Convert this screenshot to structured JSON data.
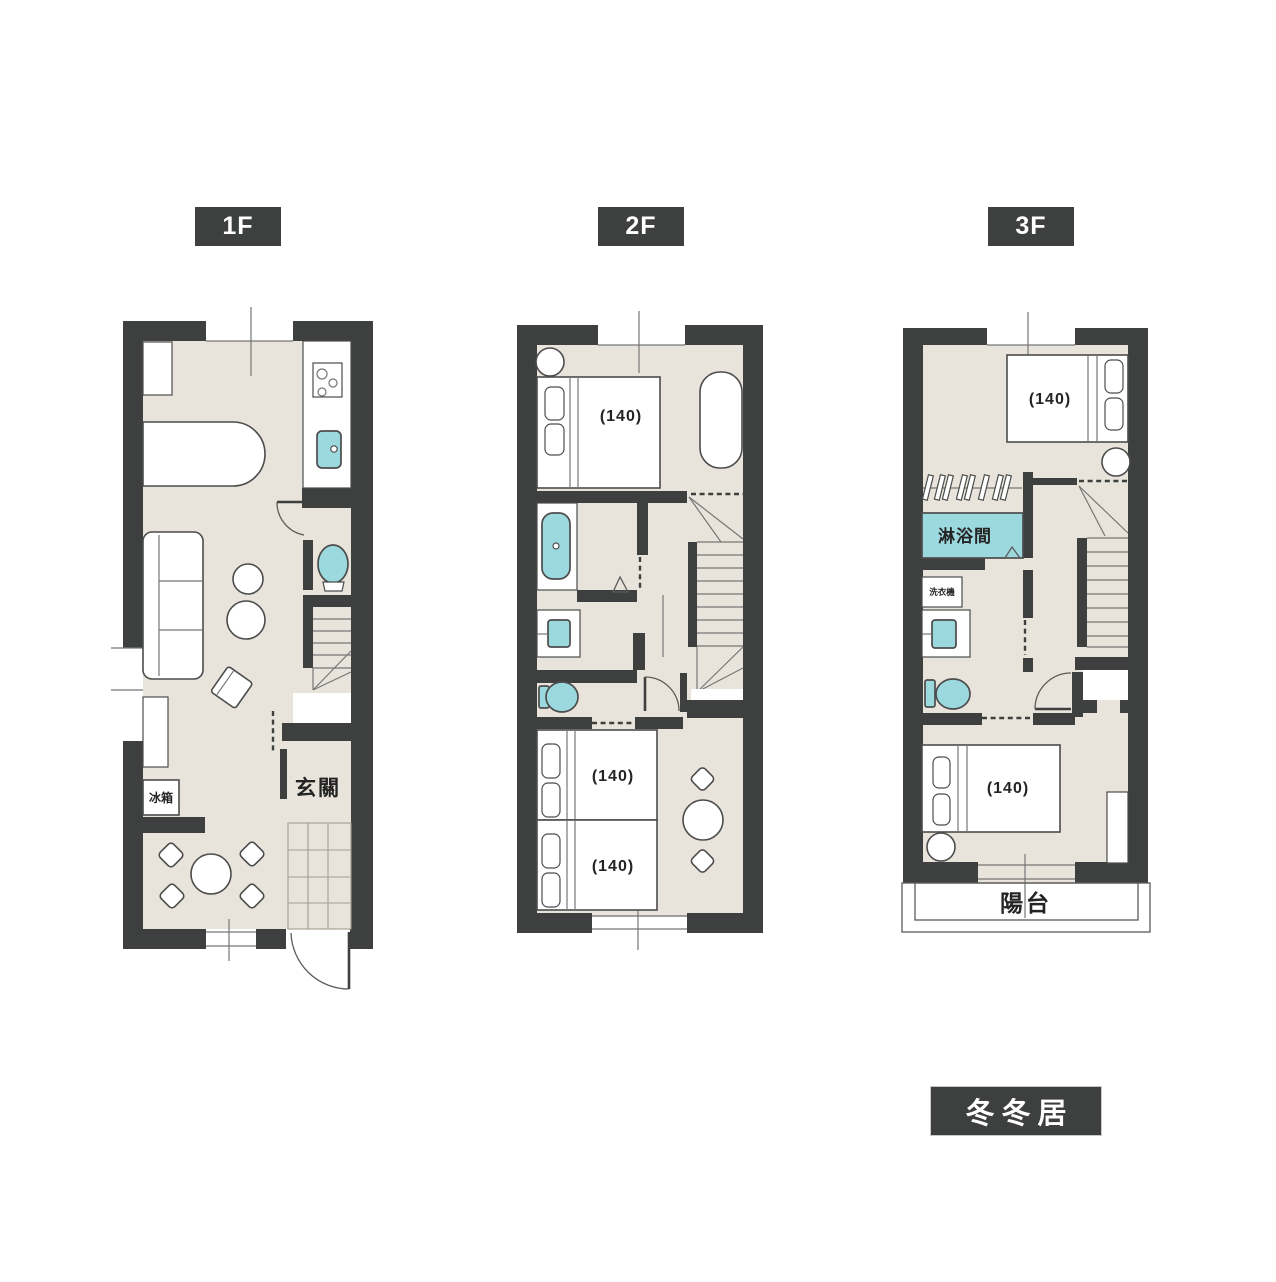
{
  "title": "三層樓平面圖",
  "brand": "冬冬居",
  "colors": {
    "wall": "#3e3f3f",
    "floor": "#e9e4db",
    "fixture_teal": "#9cd9df",
    "outline": "#4c4c4c",
    "line": "#767676",
    "text_dark": "#242424"
  },
  "floors": [
    {
      "tag": "1F",
      "labels": {
        "fridge": "冰箱",
        "entrance": "玄關"
      },
      "rooms": [
        "kitchen",
        "living-dining",
        "toilet",
        "entrance"
      ]
    },
    {
      "tag": "2F",
      "beds": [
        "(140)",
        "(140)",
        "(140)"
      ],
      "rooms": [
        "bedroom",
        "bathroom",
        "toilet",
        "bedroom"
      ]
    },
    {
      "tag": "3F",
      "beds": [
        "(140)",
        "(140)"
      ],
      "labels": {
        "shower": "淋浴間",
        "washer": "洗衣機",
        "balcony": "陽台"
      },
      "rooms": [
        "bedroom",
        "shower",
        "toilet",
        "bedroom",
        "balcony"
      ]
    }
  ]
}
